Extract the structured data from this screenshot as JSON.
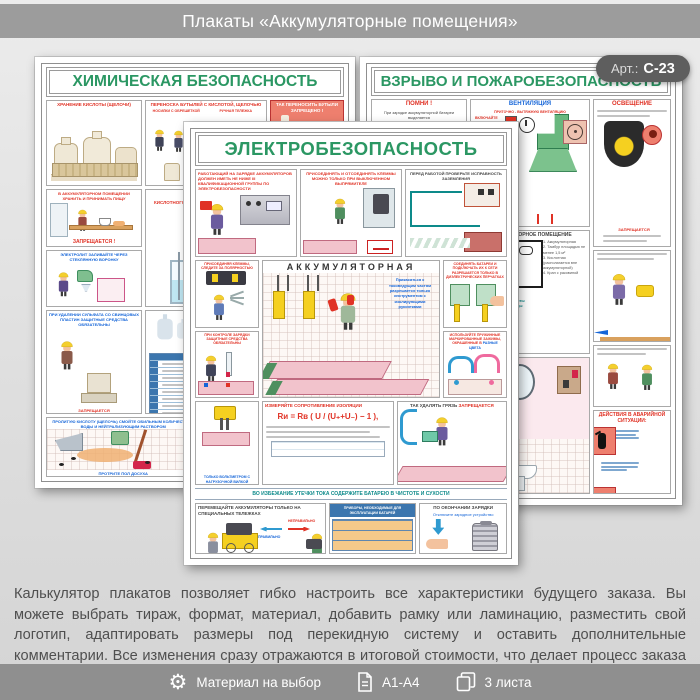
{
  "header": {
    "title": "Плакаты «Аккумуляторные помещения»"
  },
  "badge": {
    "label": "Арт.:",
    "value": "С-23"
  },
  "p": {
    "chem": {
      "title": "ХИМИЧЕСКАЯ БЕЗОПАСНОСТЬ",
      "storage": "ХРАНЕНИЕ КИСЛОТЫ (ЩЕЛОЧИ)",
      "carry": "ПЕРЕНОСКА БУТЫЛЕЙ С КИСЛОТОЙ, ЩЕЛОЧЬЮ",
      "carry_a": "НОСИЛКИ С ОБРЕШЕТКОЙ",
      "carry_b": "РУЧНАЯ ТЕЛЕЖКА",
      "forbid": "ТАК ПЕРЕНОСИТЬ БУТЫЛИ ЗАПРЕЩЕНО !",
      "food": "В АККУМУЛЯТОРНОМ ПОМЕЩЕНИИ ХРАНИТЬ И ПРИНИМАТЬ ПИЩУ",
      "food_ban": "ЗАПРЕЩАЕТСЯ !",
      "prep": "ПРИГОТОВЛЕНИЕ ЭЛЕКТРОЛИТА",
      "prep_sub": "КИСЛОТНОГО",
      "pour": "ЭЛЕКТРОЛИТ ЗАЛИВАЙТЕ ЧЕРЕЗ СТЕКЛЯННУЮ ВОРОНКУ",
      "sulfate": "ПРИ УДАЛЕНИИ СУЛЬФАТА СО СВИНЦОВЫХ ПЛАСТИН ЗАЩИТНЫЕ СРЕДСТВА ОБЯЗАТЕЛЬНЫ",
      "ppe": "ИНДИВИДУАЛЬНЫЕ ЗАЩИТНЫЕ СРЕДСТВА",
      "ppe_col": "НАИМЕНОВАНИЕ",
      "spill": "ПРОЛИТУЮ КИСЛОТУ (ЩЕЛОЧЬ) СМОЙТЕ ОБИЛЬНЫМ КОЛИЧЕСТВОМ ВОДЫ И НЕЙТРАЛИЗУЮЩИМ РАСТВОРОМ",
      "spill_cap": "ПРОТРИТЕ ПОЛ ДОСУХА",
      "waste": "ОТРАБОТАННЫЙ ЭЛЕКТРОЛИТ СЛИВАЙТЕ В СПЕЦИАЛЬНУЮ ЕМКОСТЬ И ОТПРАВЛЯЙТЕ НА НЕЙТРАЛИЗАЦИЮ"
    },
    "fire": {
      "title": "ВЗРЫВО И ПОЖАРОБЕЗОПАСНОСТЬ",
      "remember": "ПОМНИ !",
      "remember_txt": "При зарядке аккумуляторной батареи выделяется",
      "cloud1": "Едкие пары серной кислоты",
      "cloud2": "Водород",
      "vent": "ВЕНТИЛЯЦИЯ",
      "vent_txt": "ПРИТОЧНО - ВЫТЯЖНУЮ ВЕНТИЛЯЦИЮ",
      "vent_on": "ВКЛЮЧАЙТЕ",
      "vent_on2": "перед началом зарядки батареи",
      "vent_off": "ВЫКЛЮЧАЙТЕ",
      "light": "ОСВЕЩЕНИЕ",
      "light_ban": "ЗАПРЕЩАЕТСЯ",
      "room": "АККУМУЛЯТОРНОЕ ПОМЕЩЕНИЕ",
      "room1": "1. Аккумуляторная",
      "room2": "2. Тамбур площадью не менее 1,5 м²",
      "room3": "3. Кислотная (располагается вне аккумуляторной)",
      "room4": "4. Кран с раковиной",
      "sup1": "Мыло",
      "sup2": "Вата 100 г",
      "sup3": "Раствор борной кислоты",
      "sup4": "Раствор питьевой соды",
      "emergency": "ДЕЙСТВИЯ В АВАРИЙНОЙ СИТУАЦИИ:"
    },
    "el": {
      "title": "ЭЛЕКТРОБЕЗОПАСНОСТЬ",
      "qual": "РАБОТАЮЩИЙ НА ЗАРЯДКЕ АККУМУЛЯТОРОВ ДОЛЖЕН ИМЕТЬ НЕ НИЖЕ III КВАЛИФИКАЦИОННОЙ ГРУППЫ ПО ЭЛЕКТРОБЕЗОПАСНОСТИ",
      "clamps": "ПРИСОЕДИНЯТЬ И ОТСОЕДИНЯТЬ КЛЕММЫ МОЖНО ТОЛЬКО ПРИ ВЫКЛЮЧЕННОМ ВЫПРЯМИТЕЛЕ",
      "ground": "ПЕРЕД РАБОТОЙ ПРОВЕРЬТЕ ИСПРАВНОСТЬ ЗАЗЕМЛЕНИЯ",
      "polarity": "ПРИСОЕДИНЯЯ КЛЕММЫ, СЛЕДИТЕ ЗА ПОЛЯРНОСТЬЮ",
      "room": "АККУМУЛЯТОРНАЯ",
      "room_note": "Прикасаться к токоведущим частям разрешается только инструментом с изолирующими рукоятками",
      "control": "ПРИ КОНТРОЛЕ ЗАРЯДКИ ЗАЩИТНЫЕ СРЕДСТВА ОБЯЗАТЕЛЬНЫ",
      "gloves": "СОЕДИНЯТЬ БАТАРЕИ И ПОДКЛЮЧАТЬ ИХ К СЕТИ РАЗРЕШАЕТСЯ ТОЛЬКО В ДИЭЛЕКТРИЧЕСКИХ ПЕРЧАТКАХ",
      "marked": "ИСПОЛЬЗУЙТЕ ПРУЖИННЫЕ МАРКИРОВАННЫЕ ЗАЖИМЫ, ОКРАШЕННЫЕ В",
      "marked_hl": "РАЗНЫЕ ЦВЕТА",
      "volt": "ТОЛЬКО ВОЛЬТМЕТРОМ С НАГРУЗОЧНОЙ ВИЛКОЙ",
      "insul": "ИЗМЕРЯЙТЕ СОПРОТИВЛЕНИЕ ИЗОЛЯЦИИ",
      "formula": "Rи = Rв ( U / (U₊+U₋) − 1 ),",
      "dirt": "ТАК УДАЛЯТЬ ГРЯЗЬ",
      "dirt_ban": "ЗАПРЕЩАЕТСЯ",
      "strip": "ВО ИЗБЕЖАНИЕ УТЕЧКИ ТОКА СОДЕРЖИТЕ БАТАРЕЮ В ЧИСТОТЕ И СУХОСТИ",
      "trolley": "ПЕРЕМЕЩАЙТЕ АККУМУЛЯТОРЫ ТОЛЬКО НА СПЕЦИАЛЬНЫХ ТЕЛЕЖКАХ",
      "wrong": "НЕПРАВИЛЬНО",
      "right": "ПРАВИЛЬНО",
      "devices": "ПРИБОРЫ, НЕОБХОДИМЫЕ ДЛЯ ЭКСПЛУАТАЦИИ БАТАРЕЙ",
      "after": "ПО ОКОНЧАНИИ ЗАРЯДКИ",
      "after1": "Отключите зарядное устройство"
    }
  },
  "description": "Калькулятор плакатов позволяет гибко настроить все характеристики будущего заказа. Вы можете выбрать тираж, формат, материал, добавить рамку или ламинацию, разместить свой логотип, адаптировать размеры под перекидную систему и оставить дополнительные комментарии. Все изменения сразу отражаются в итоговой стоимости, что делает процесс заказа быстрым и прозрачным",
  "footer": {
    "items": [
      {
        "icon": "gear-icon",
        "label": "Материал на выбор"
      },
      {
        "icon": "document-icon",
        "label": "А1-А4"
      },
      {
        "icon": "sheets-icon",
        "label": "3 листа"
      }
    ]
  },
  "colors": {
    "header_bar": "#9c9c9c",
    "footer_bar": "#8f8f8f",
    "badge": "#5e5e5e",
    "title_green": "#2b9763",
    "warning_red": "#e03225",
    "info_blue": "#1565d8"
  }
}
